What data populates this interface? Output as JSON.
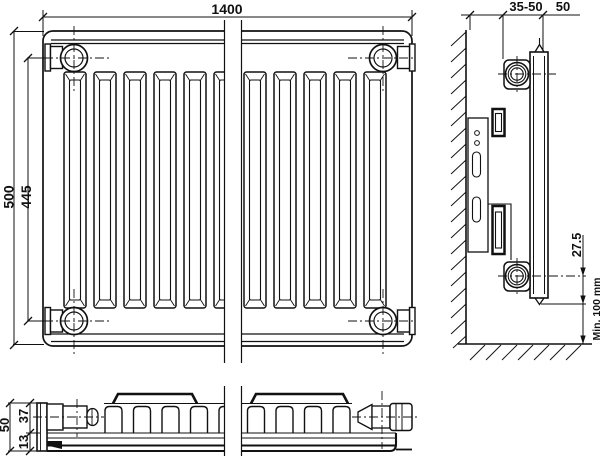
{
  "dimensions": {
    "front": {
      "width": "1400",
      "height": "500",
      "connection_spacing": "445"
    },
    "side": {
      "wall_distance": "35-50",
      "depth": "50",
      "connection_offset": "27.5",
      "floor_clearance": "Min. 100 mm"
    },
    "bottom": {
      "overall_depth": "50",
      "convector_depth": "37",
      "panel_thickness": "13"
    }
  }
}
